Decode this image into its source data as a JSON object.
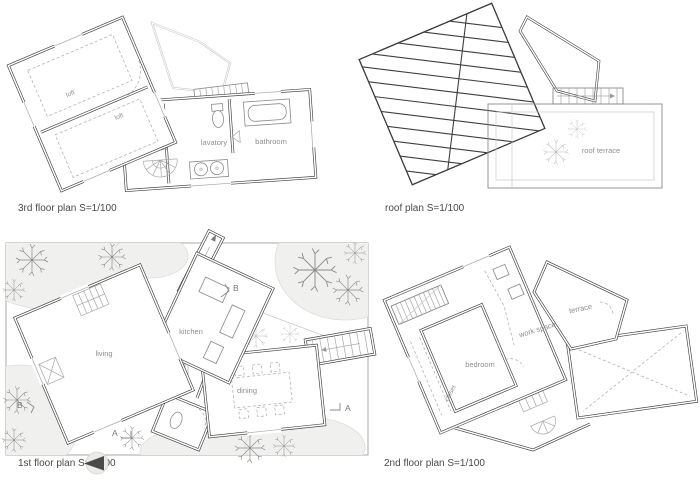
{
  "sheet": {
    "background": "#ffffff",
    "wall_color": "#3e3e3e",
    "label_color": "#8f8f8f",
    "ground_color": "#f0f1ee"
  },
  "plans": {
    "third_floor": {
      "caption": "3rd floor plan  S=1/100",
      "rooms": {
        "loft_upper": "loft",
        "loft_lower": "loft",
        "lavatory": "lavatory",
        "bathroom": "bathroom"
      }
    },
    "roof": {
      "caption": "roof plan  S=1/100",
      "rooms": {
        "roof_terrace": "roof terrace"
      }
    },
    "first_floor": {
      "caption": "1st floor plan  S=1/100",
      "rooms": {
        "living": "living",
        "kitchen": "kitchen",
        "dining": "dining"
      },
      "markers": {
        "a": "A",
        "b": "B"
      }
    },
    "second_floor": {
      "caption": "2nd floor plan  S=1/100",
      "rooms": {
        "bedroom": "bedroom",
        "closet": "closet",
        "work_space": "work space",
        "terrace": "terrace"
      }
    }
  }
}
